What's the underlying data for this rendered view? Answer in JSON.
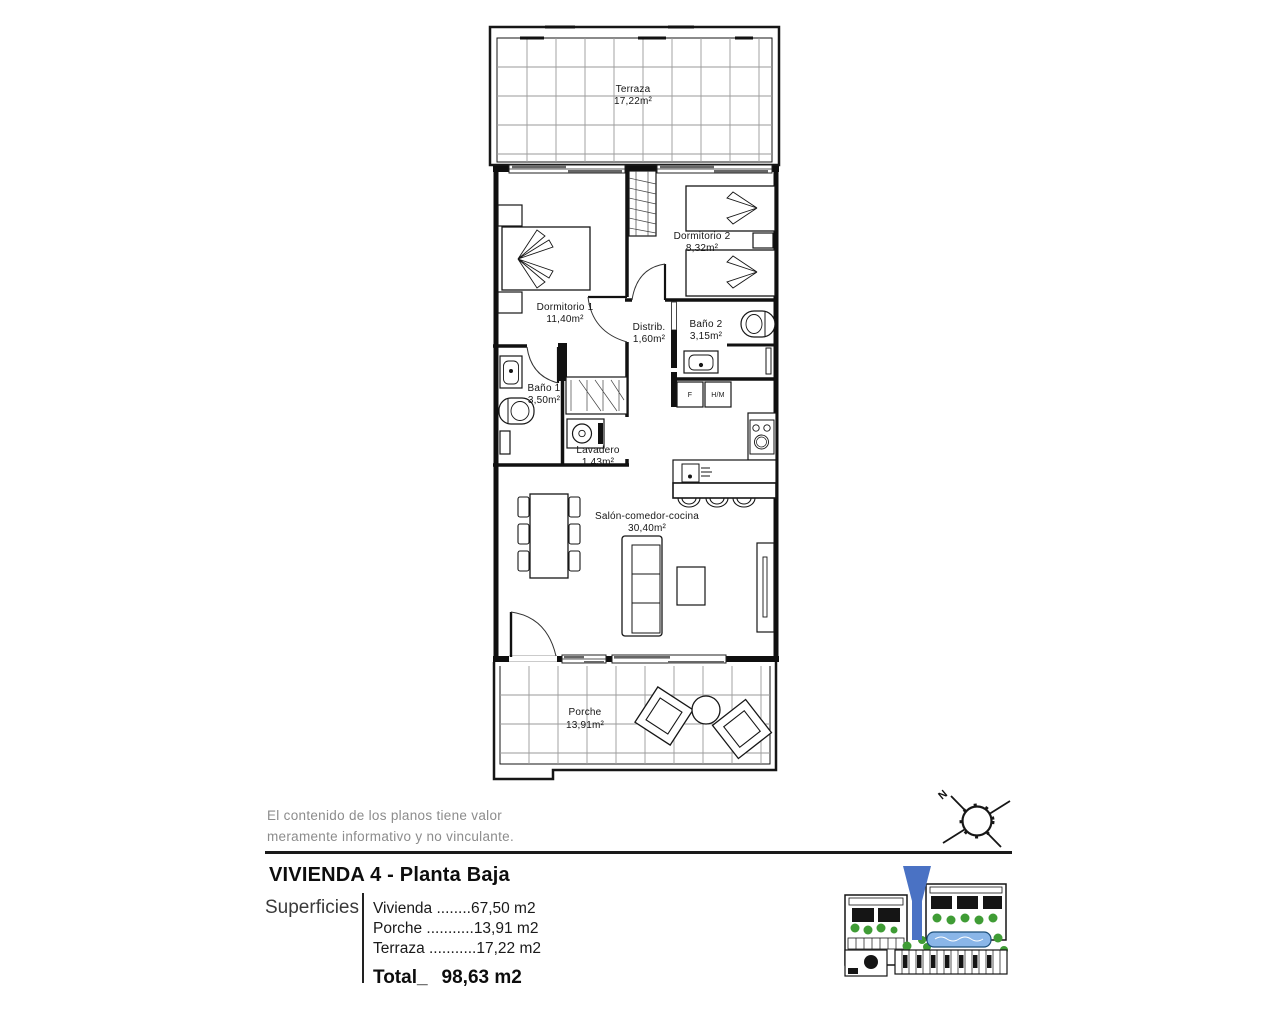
{
  "document": {
    "disclaimer_line1": "El contenido de los planos tiene valor",
    "disclaimer_line2": "meramente informativo y no vinculante.",
    "title": "VIVIENDA 4 - Planta Baja",
    "superficies": {
      "label": "Superficies",
      "rows": [
        {
          "name": "Vivienda",
          "dots": " ........",
          "value": "67,50 m2"
        },
        {
          "name": "Porche",
          "dots": " ...........",
          "value": "13,91 m2"
        },
        {
          "name": "Terraza",
          "dots": " ...........",
          "value": "17,22 m2"
        }
      ],
      "total_label": "Total_",
      "total_value": "98,63 m2"
    }
  },
  "floorplan": {
    "rooms": {
      "terraza": {
        "label": "Terraza",
        "area": "17,22m²"
      },
      "dormitorio1": {
        "label": "Dormitorio 1",
        "area": "11,40m²"
      },
      "dormitorio2": {
        "label": "Dormitorio 2",
        "area": "8,32m²"
      },
      "distribuidor": {
        "label": "Distrib.",
        "area": "1,60m²"
      },
      "bano1": {
        "label": "Baño 1",
        "area": "3,50m²"
      },
      "bano2": {
        "label": "Baño 2",
        "area": "3,15m²"
      },
      "lavadero": {
        "label": "Lavadero",
        "area": "1,43m²"
      },
      "salon": {
        "label": "Salón-comedor-cocina",
        "area": "30,40m²"
      },
      "porche": {
        "label": "Porche",
        "area": "13,91m²"
      }
    },
    "kitchen": {
      "fridge_label": "F",
      "oven_label": "H/M"
    }
  },
  "compass": {
    "north_label": "N"
  },
  "site_plan": {
    "marker_color": "#4a72c4",
    "vegetation_color": "#3f9c35",
    "pool_color": "#8ab6e8"
  }
}
